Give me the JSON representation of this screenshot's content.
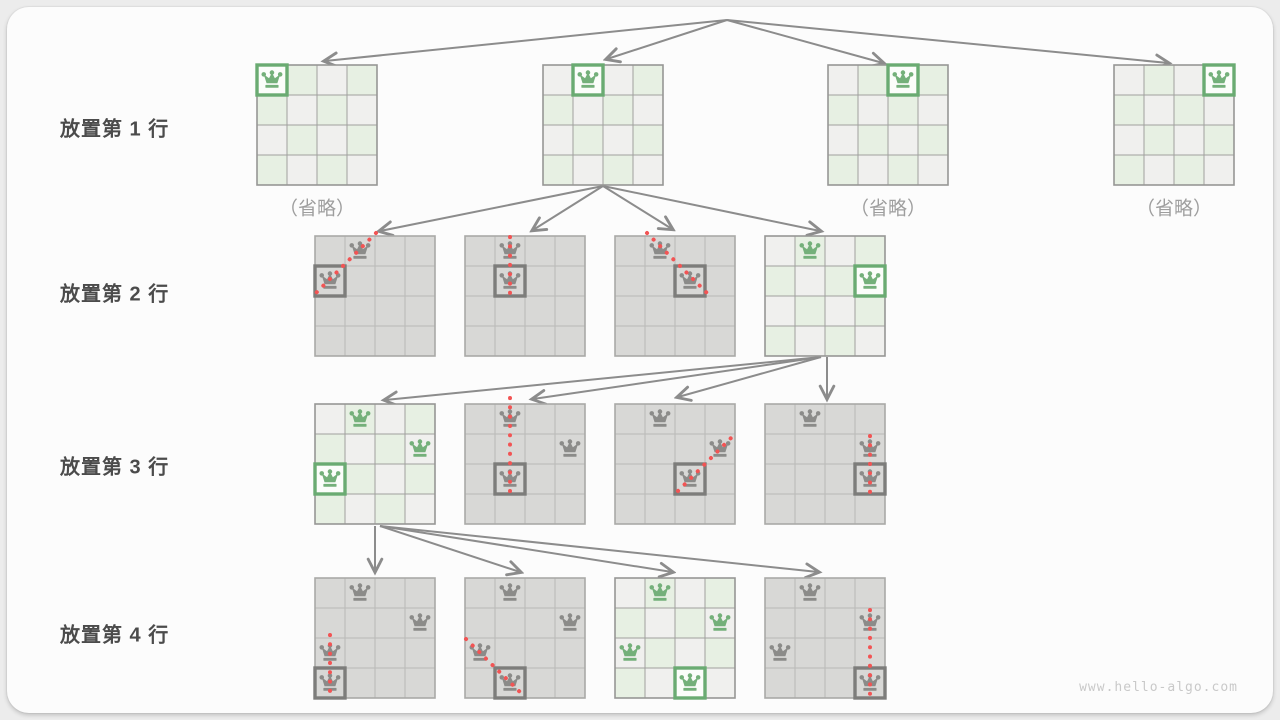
{
  "page": {
    "watermark": "www.hello-algo.com"
  },
  "palette": {
    "page_bg": "#ececec",
    "card_bg": "#fcfcfc",
    "light_cell": "#f0f0ee",
    "green_cell": "#e7f0e3",
    "gray_cell": "#d8d8d6",
    "light_grid": "#a0a09e",
    "light_border": "#979795",
    "gray_grid": "#b9b9b7",
    "gray_border": "#a9a9a7",
    "green": "#74b07a",
    "green_box": "#6aab72",
    "green_box_fill": "#fbfdfa",
    "gray_queen": "#8b8b89",
    "gray_box": "#7d7d7b",
    "red": "#f25454",
    "arrow": "#8c8c8c",
    "label_text": "#4b4b4b",
    "muted_text": "#9e9e9e",
    "watermark_text": "#c9c9c9"
  },
  "row_labels": [
    {
      "text": "放置第 1 行",
      "x": 60,
      "cy": 127
    },
    {
      "text": "放置第 2 行",
      "x": 60,
      "cy": 292
    },
    {
      "text": "放置第 3 行",
      "x": 60,
      "cy": 465
    },
    {
      "text": "放置第 4 行",
      "x": 60,
      "cy": 633
    }
  ],
  "omitted_labels": [
    {
      "text": "（省略）",
      "cx": 317,
      "cy": 207
    },
    {
      "text": "（省略）",
      "cx": 888,
      "cy": 207
    },
    {
      "text": "（省略）",
      "cx": 1174,
      "cy": 207
    }
  ],
  "boards": [
    {
      "name": "board-row1-option1",
      "x": 256,
      "y": 64,
      "style": "light",
      "queens": [
        {
          "r": 0,
          "c": 0,
          "color": "green",
          "box": true
        }
      ],
      "conflict": null
    },
    {
      "name": "board-row1-option2",
      "x": 542,
      "y": 64,
      "style": "light",
      "queens": [
        {
          "r": 0,
          "c": 1,
          "color": "green",
          "box": true
        }
      ],
      "conflict": null
    },
    {
      "name": "board-row1-option3",
      "x": 827,
      "y": 64,
      "style": "light",
      "queens": [
        {
          "r": 0,
          "c": 2,
          "color": "green",
          "box": true
        }
      ],
      "conflict": null
    },
    {
      "name": "board-row1-option4",
      "x": 1113,
      "y": 64,
      "style": "light",
      "queens": [
        {
          "r": 0,
          "c": 3,
          "color": "green",
          "box": true
        }
      ],
      "conflict": null
    },
    {
      "name": "board-row2-option1",
      "x": 314,
      "y": 235,
      "style": "gray",
      "queens": [
        {
          "r": 0,
          "c": 1,
          "color": "gray",
          "box": false
        },
        {
          "r": 1,
          "c": 0,
          "color": "gray",
          "box": true
        }
      ],
      "conflict": {
        "x1": 62,
        "y1": -2,
        "x2": 0,
        "y2": 60
      }
    },
    {
      "name": "board-row2-option2",
      "x": 464,
      "y": 235,
      "style": "gray",
      "queens": [
        {
          "r": 0,
          "c": 1,
          "color": "gray",
          "box": false
        },
        {
          "r": 1,
          "c": 1,
          "color": "gray",
          "box": true
        }
      ],
      "conflict": {
        "x1": 46,
        "y1": 2,
        "x2": 46,
        "y2": 58
      }
    },
    {
      "name": "board-row2-option3",
      "x": 614,
      "y": 235,
      "style": "gray",
      "queens": [
        {
          "r": 0,
          "c": 1,
          "color": "gray",
          "box": false
        },
        {
          "r": 1,
          "c": 2,
          "color": "gray",
          "box": true
        }
      ],
      "conflict": {
        "x1": 33,
        "y1": -2,
        "x2": 93,
        "y2": 58
      }
    },
    {
      "name": "board-row2-option4",
      "x": 764,
      "y": 235,
      "style": "light",
      "queens": [
        {
          "r": 0,
          "c": 1,
          "color": "green",
          "box": false
        },
        {
          "r": 1,
          "c": 3,
          "color": "green",
          "box": true
        }
      ],
      "conflict": null
    },
    {
      "name": "board-row3-option1",
      "x": 314,
      "y": 403,
      "style": "light",
      "queens": [
        {
          "r": 0,
          "c": 1,
          "color": "green",
          "box": false
        },
        {
          "r": 1,
          "c": 3,
          "color": "green",
          "box": false
        },
        {
          "r": 2,
          "c": 0,
          "color": "green",
          "box": true
        }
      ],
      "conflict": null
    },
    {
      "name": "board-row3-option2",
      "x": 464,
      "y": 403,
      "style": "gray",
      "queens": [
        {
          "r": 0,
          "c": 1,
          "color": "gray",
          "box": false
        },
        {
          "r": 1,
          "c": 3,
          "color": "gray",
          "box": false
        },
        {
          "r": 2,
          "c": 1,
          "color": "gray",
          "box": true
        }
      ],
      "conflict": {
        "x1": 46,
        "y1": -5,
        "x2": 46,
        "y2": 89
      }
    },
    {
      "name": "board-row3-option3",
      "x": 614,
      "y": 403,
      "style": "gray",
      "queens": [
        {
          "r": 0,
          "c": 1,
          "color": "gray",
          "box": false
        },
        {
          "r": 1,
          "c": 3,
          "color": "gray",
          "box": false
        },
        {
          "r": 2,
          "c": 2,
          "color": "gray",
          "box": true
        }
      ],
      "conflict": {
        "x1": 64,
        "y1": 88,
        "x2": 118,
        "y2": 34
      }
    },
    {
      "name": "board-row3-option4",
      "x": 764,
      "y": 403,
      "style": "gray",
      "queens": [
        {
          "r": 0,
          "c": 1,
          "color": "gray",
          "box": false
        },
        {
          "r": 1,
          "c": 3,
          "color": "gray",
          "box": false
        },
        {
          "r": 2,
          "c": 3,
          "color": "gray",
          "box": true
        }
      ],
      "conflict": {
        "x1": 106,
        "y1": 33,
        "x2": 106,
        "y2": 90
      }
    },
    {
      "name": "board-row4-option1",
      "x": 314,
      "y": 577,
      "style": "gray",
      "queens": [
        {
          "r": 0,
          "c": 1,
          "color": "gray",
          "box": false
        },
        {
          "r": 1,
          "c": 3,
          "color": "gray",
          "box": false
        },
        {
          "r": 2,
          "c": 0,
          "color": "gray",
          "box": false
        },
        {
          "r": 3,
          "c": 0,
          "color": "gray",
          "box": true
        }
      ],
      "conflict": {
        "x1": 16,
        "y1": 58,
        "x2": 16,
        "y2": 119
      }
    },
    {
      "name": "board-row4-option2",
      "x": 464,
      "y": 577,
      "style": "gray",
      "queens": [
        {
          "r": 0,
          "c": 1,
          "color": "gray",
          "box": false
        },
        {
          "r": 1,
          "c": 3,
          "color": "gray",
          "box": false
        },
        {
          "r": 2,
          "c": 0,
          "color": "gray",
          "box": false
        },
        {
          "r": 3,
          "c": 1,
          "color": "gray",
          "box": true
        }
      ],
      "conflict": {
        "x1": 2,
        "y1": 62,
        "x2": 60,
        "y2": 119
      }
    },
    {
      "name": "board-row4-option3",
      "x": 614,
      "y": 577,
      "style": "light",
      "queens": [
        {
          "r": 0,
          "c": 1,
          "color": "green",
          "box": false
        },
        {
          "r": 1,
          "c": 3,
          "color": "green",
          "box": false
        },
        {
          "r": 2,
          "c": 0,
          "color": "green",
          "box": false
        },
        {
          "r": 3,
          "c": 2,
          "color": "green",
          "box": true
        }
      ],
      "conflict": null
    },
    {
      "name": "board-row4-option4",
      "x": 764,
      "y": 577,
      "style": "gray",
      "queens": [
        {
          "r": 0,
          "c": 1,
          "color": "gray",
          "box": false
        },
        {
          "r": 1,
          "c": 3,
          "color": "gray",
          "box": false
        },
        {
          "r": 2,
          "c": 0,
          "color": "gray",
          "box": false
        },
        {
          "r": 3,
          "c": 3,
          "color": "gray",
          "box": true
        }
      ],
      "conflict": {
        "x1": 106,
        "y1": 33,
        "x2": 106,
        "y2": 119
      }
    }
  ],
  "arrows": [
    {
      "x1": 727,
      "y1": 20,
      "x2": 325,
      "y2": 61
    },
    {
      "x1": 727,
      "y1": 20,
      "x2": 607,
      "y2": 59
    },
    {
      "x1": 727,
      "y1": 20,
      "x2": 883,
      "y2": 63
    },
    {
      "x1": 727,
      "y1": 20,
      "x2": 1168,
      "y2": 63
    },
    {
      "x1": 603,
      "y1": 186,
      "x2": 380,
      "y2": 231
    },
    {
      "x1": 603,
      "y1": 186,
      "x2": 533,
      "y2": 230
    },
    {
      "x1": 603,
      "y1": 186,
      "x2": 672,
      "y2": 229
    },
    {
      "x1": 603,
      "y1": 186,
      "x2": 820,
      "y2": 231
    },
    {
      "x1": 821,
      "y1": 357,
      "x2": 385,
      "y2": 400
    },
    {
      "x1": 821,
      "y1": 357,
      "x2": 533,
      "y2": 399
    },
    {
      "x1": 821,
      "y1": 357,
      "x2": 678,
      "y2": 397
    },
    {
      "x1": 827,
      "y1": 357,
      "x2": 827,
      "y2": 398
    },
    {
      "x1": 375,
      "y1": 526,
      "x2": 375,
      "y2": 571
    },
    {
      "x1": 380,
      "y1": 526,
      "x2": 520,
      "y2": 572
    },
    {
      "x1": 380,
      "y1": 526,
      "x2": 672,
      "y2": 572
    },
    {
      "x1": 380,
      "y1": 526,
      "x2": 818,
      "y2": 572
    }
  ]
}
